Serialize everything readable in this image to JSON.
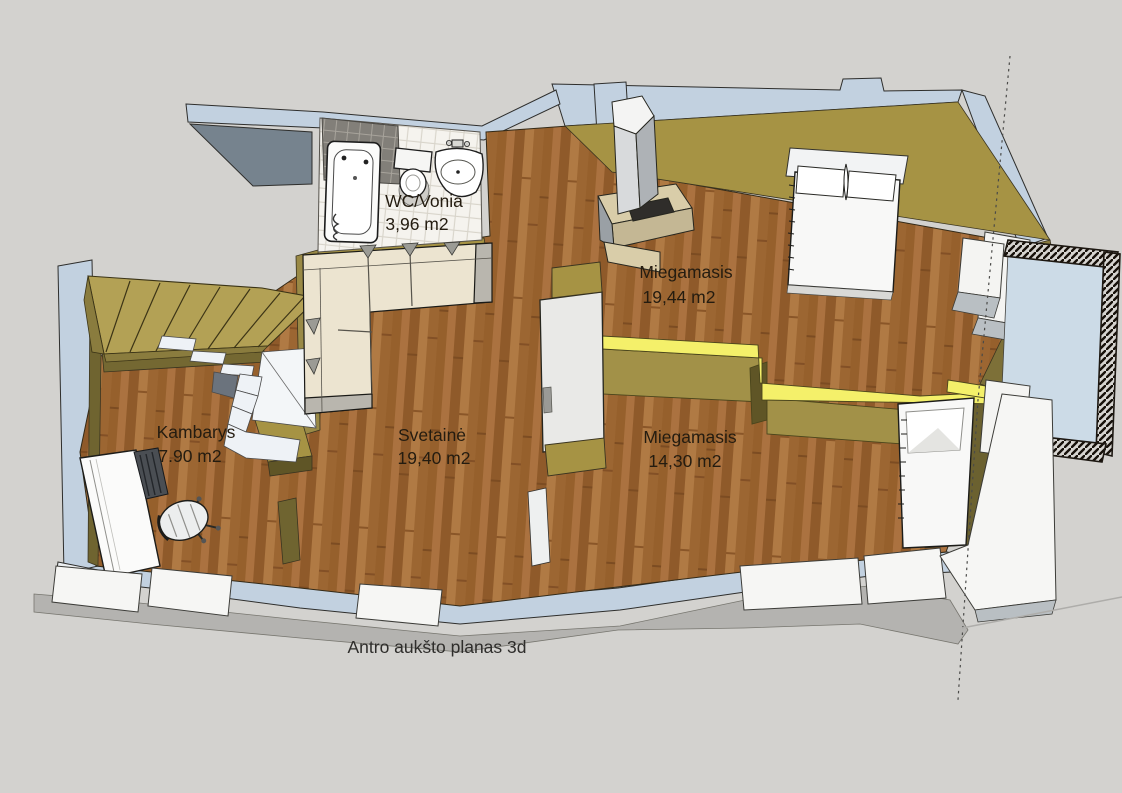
{
  "title": "Antro aukšto planas 3d",
  "caption": "Antro aukšto planas 3d",
  "rooms": [
    {
      "name": "WC/Vonia",
      "area": "3,96 m2"
    },
    {
      "name": "Miegamasis",
      "area": "19,44 m2"
    },
    {
      "name": "Kambarys",
      "area": "7.90 m2"
    },
    {
      "name": "Svetainė",
      "area": "19,40 m2"
    },
    {
      "name": "Miegamasis",
      "area": "14,30 m2"
    }
  ],
  "objects": [
    "bathtub",
    "toilet",
    "sink",
    "corner-sofa",
    "double-bed",
    "single-bed",
    "fireplace",
    "staircase",
    "sloped-roof",
    "desk",
    "office-chair",
    "balcony",
    "balcony-railing",
    "wardrobe-divider"
  ],
  "colors": {
    "background": "#d3d2cf",
    "exterior_wall_top": "#c2d1e0",
    "interior_wall_top": "#a69344",
    "interior_wall_face": "#6f6430",
    "accent_wall_yellow": "#f4f06a",
    "floor_wood": "#a26a38",
    "bathroom_tile": "#f5f3ee",
    "balcony_floor": "#ccdbe7",
    "railing_dark": "#1d1812",
    "furniture_white": "#f6f6f4",
    "sofa_cream": "#ece4d0",
    "fireplace_beige": "#d9cda9",
    "label_text": "#241c10"
  }
}
